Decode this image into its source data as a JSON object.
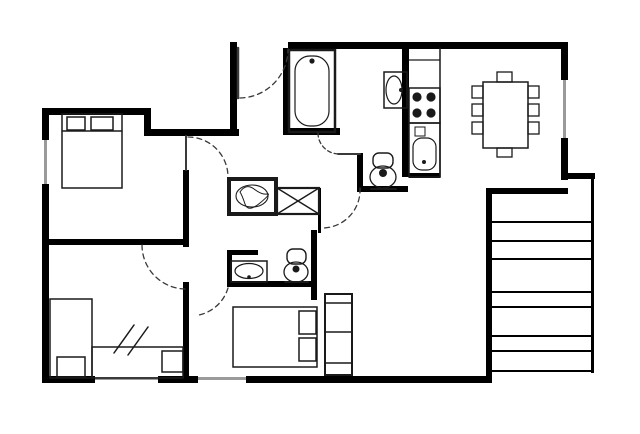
{
  "plan": {
    "colors": {
      "bg": "#ffffff",
      "wall": "#000000",
      "fixture": "#1a1a1a",
      "window": "#9a9a9a",
      "door": "#3a3a3a"
    },
    "depicted": {
      "bedrooms": {
        "bed_count": 4,
        "pillow_count": 6,
        "wardrobe_count": 1,
        "note-marks": "double-slash-on-bed"
      },
      "bathrooms": {
        "bathtub_count": 1,
        "toilet_count": 2,
        "washbasin_count": 2
      },
      "kitchen": {
        "stove_burner_count": 4,
        "sink_count": 1,
        "counter_sections": 3
      },
      "dining": {
        "table_count": 1,
        "chair_count": 8
      },
      "laundry": {
        "washing_machine_count": 1,
        "crossed_box_count": 1
      },
      "stairs": {
        "step_line_count": 8
      },
      "windows": {
        "count": 4
      },
      "door_swings": {
        "count": 6
      }
    }
  }
}
